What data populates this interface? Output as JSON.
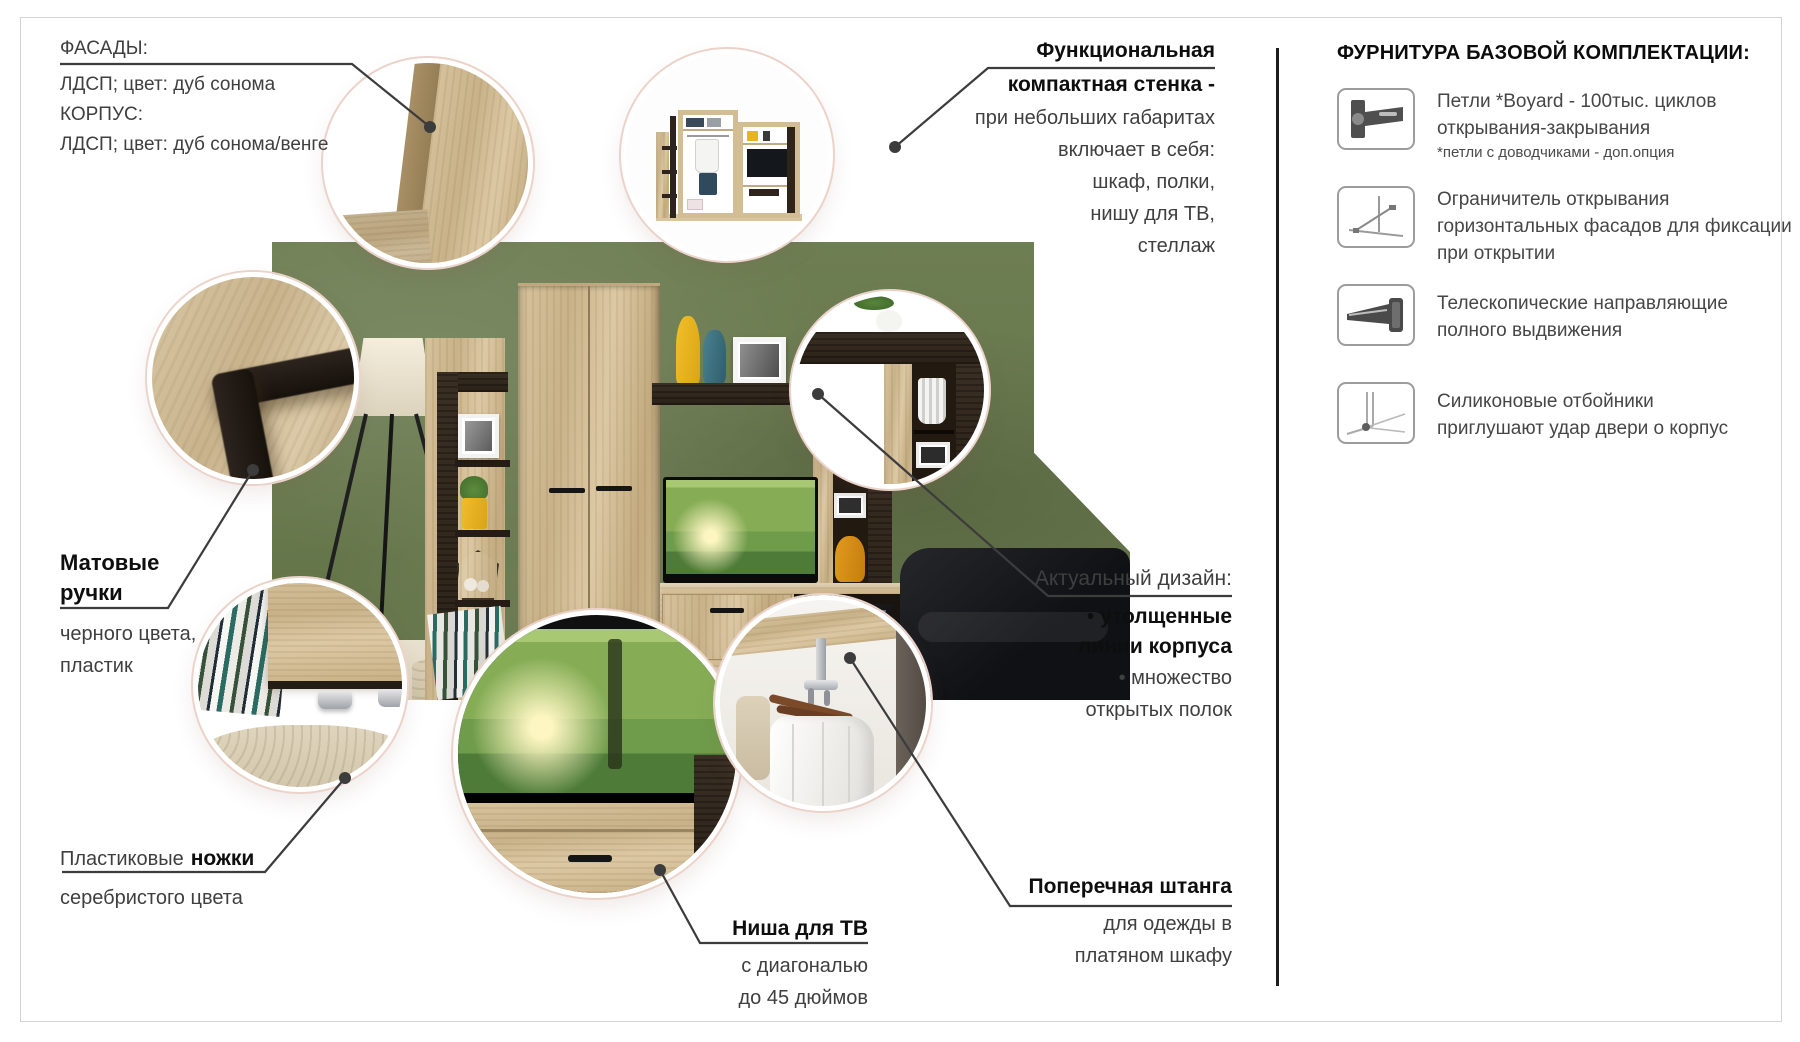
{
  "colors": {
    "wall_green": "#68784d",
    "oak_light": "#d2bd95",
    "venge_dark": "#2e241b",
    "accent_yellow": "#e8b520",
    "text_regular": "#3f3f3f",
    "text_bold": "#0e0e0e",
    "callout_line": "#3c3c3c",
    "circle_ring_outline": "#ecd3ca"
  },
  "callouts": {
    "facade": {
      "title": "ФАСАДЫ:",
      "line1": "ЛДСП; цвет: дуб сонома",
      "line2": "КОРПУС:",
      "line3": "ЛДСП; цвет: дуб сонома/венге"
    },
    "compact": {
      "bold1": "Функциональная",
      "bold2": "компактная стенка -",
      "line1": "при небольших габаритах",
      "line2": "включает в себя:",
      "line3": "шкаф, полки,",
      "line4": "нишу для ТВ,",
      "line5": "стеллаж"
    },
    "handles": {
      "bold1": "Матовые",
      "bold2": "ручки",
      "line1": "черного цвета,",
      "line2": "пластик"
    },
    "design": {
      "title": "Актуальный дизайн:",
      "bold1": "• утолщенные",
      "bold2": "линии корпуса",
      "line1": "• множество",
      "line2": "открытых полок"
    },
    "legs": {
      "prefix": "Пластиковые",
      "bold": "ножки",
      "line1": "серебристого цвета"
    },
    "tv_niche": {
      "bold": "Ниша для ТВ",
      "line1": "с диагональю",
      "line2": "до 45 дюймов"
    },
    "rod": {
      "bold": "Поперечная штанга",
      "line1": "для одежды в",
      "line2": "платяном шкафу"
    }
  },
  "sidebar": {
    "title": "ФУРНИТУРА БАЗОВОЙ КОМПЛЕКТАЦИИ:",
    "items": [
      {
        "icon": "hinge-icon",
        "line1": "Петли *Boyard - 100тыс. циклов",
        "line2": "открывания-закрывания",
        "note": "*петли с доводчиками - доп.опция"
      },
      {
        "icon": "door-stay-icon",
        "line1": "Ограничитель открывания",
        "line2": "горизонтальных фасадов для фиксации",
        "line3": "при открытии"
      },
      {
        "icon": "drawer-slide-icon",
        "line1": "Телескопические направляющие",
        "line2": "полного выдвижения"
      },
      {
        "icon": "silicone-bumper-icon",
        "line1": "Силиконовые отбойники",
        "line2": "приглушают удар двери о корпус"
      }
    ]
  }
}
